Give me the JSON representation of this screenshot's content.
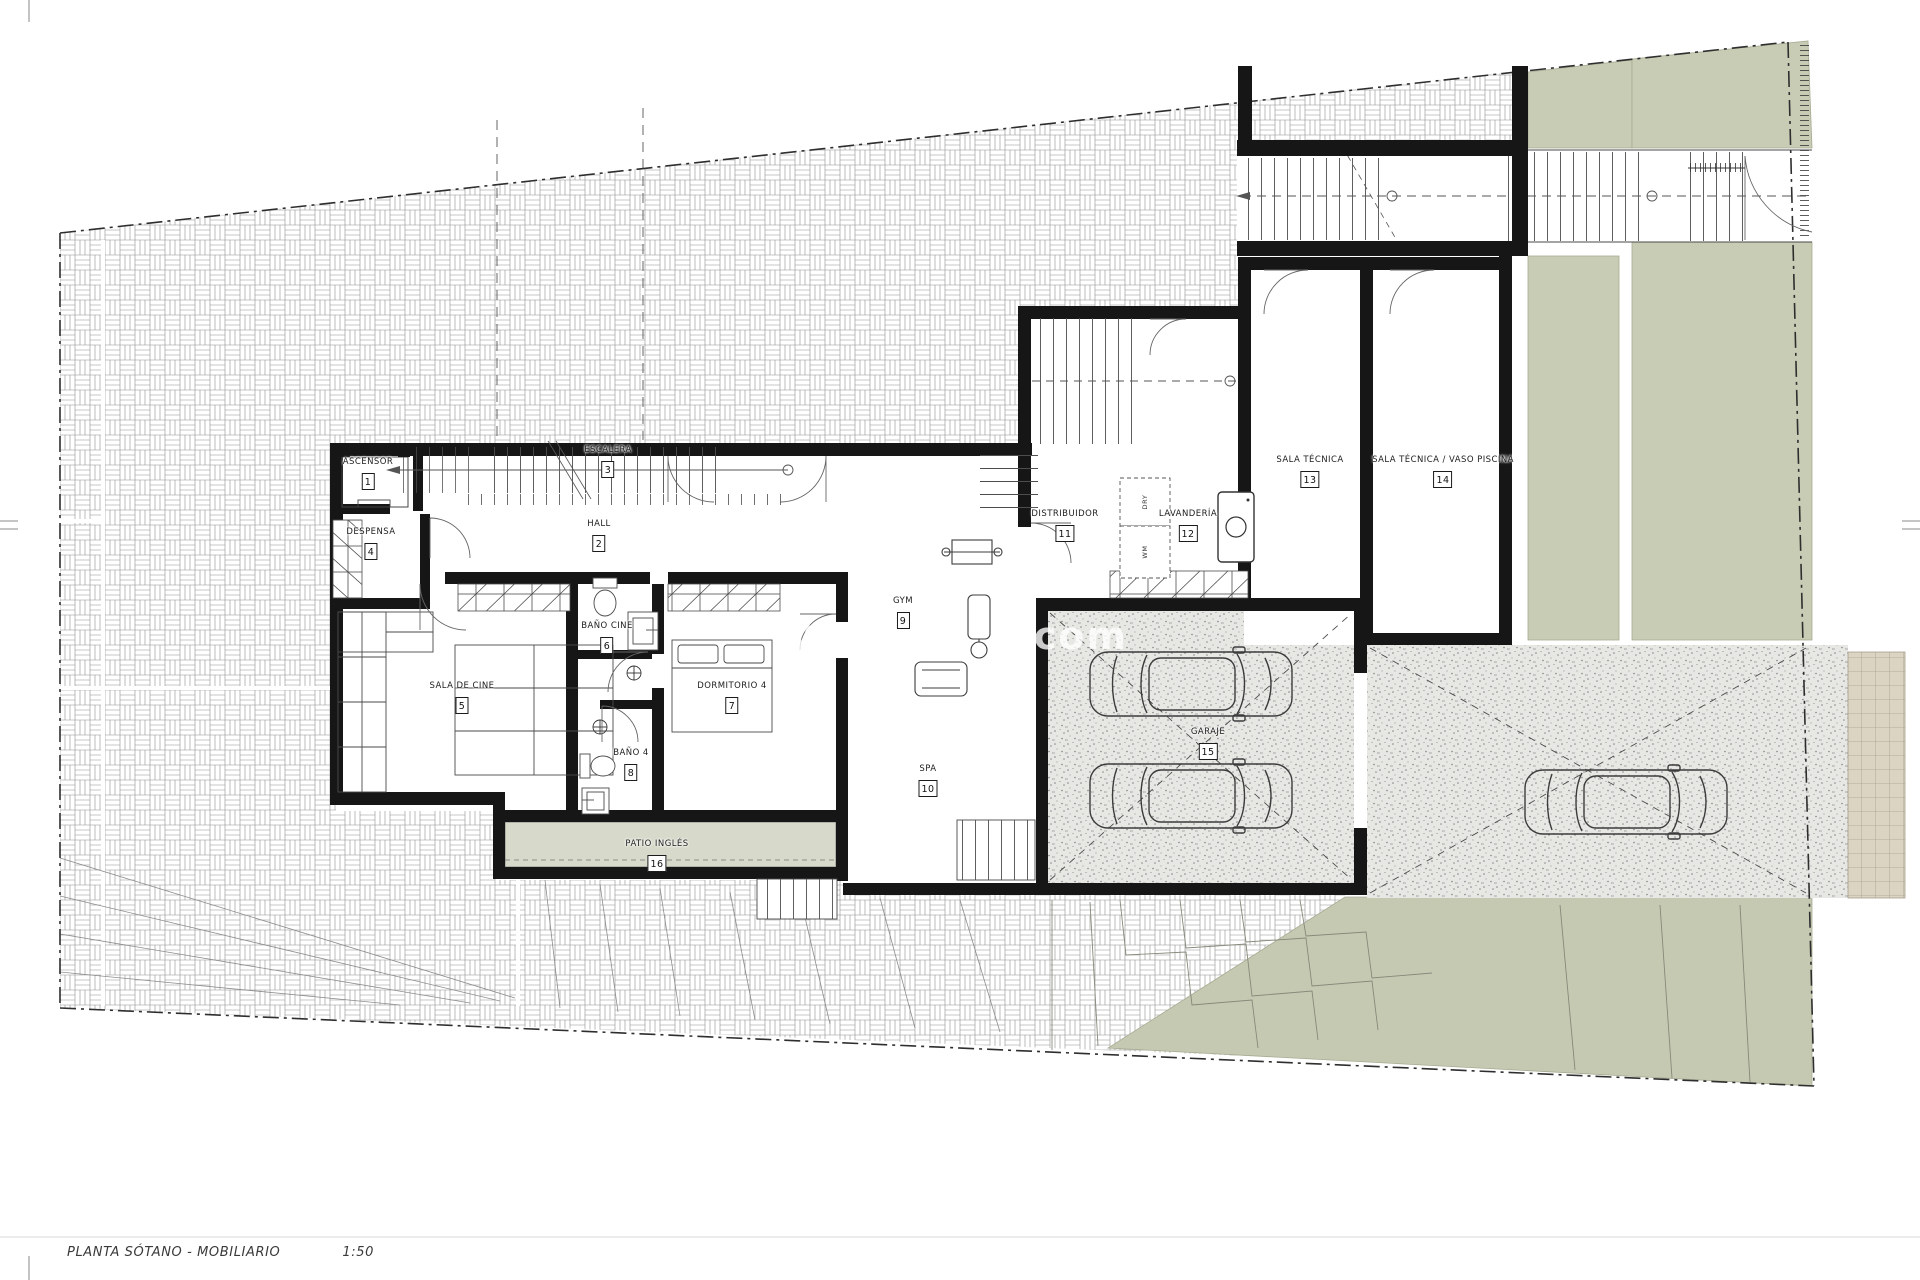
{
  "footer": {
    "title": "PLANTA SÓTANO - MOBILIARIO",
    "scale": "1:50"
  },
  "watermark": {
    "left_fragment": "w",
    "right_fragment": "o.com"
  },
  "rooms": [
    {
      "number": "1",
      "label": "ASCENSOR"
    },
    {
      "number": "2",
      "label": "HALL"
    },
    {
      "number": "3",
      "label": "ESCALERA"
    },
    {
      "number": "4",
      "label": "DESPENSA"
    },
    {
      "number": "5",
      "label": "SALA DE CINE"
    },
    {
      "number": "6",
      "label": "BAÑO CINE"
    },
    {
      "number": "7",
      "label": "DORMITORIO 4"
    },
    {
      "number": "8",
      "label": "BAÑO 4"
    },
    {
      "number": "9",
      "label": "GYM"
    },
    {
      "number": "10",
      "label": "SPA"
    },
    {
      "number": "11",
      "label": "DISTRIBUIDOR"
    },
    {
      "number": "12",
      "label": "LAVANDERÍA"
    },
    {
      "number": "13",
      "label": "SALA TÉCNICA"
    },
    {
      "number": "14",
      "label": "SALA TÉCNICA / VASO PISCINA"
    },
    {
      "number": "15",
      "label": "GARAJE"
    },
    {
      "number": "16",
      "label": "PATIO INGLÉS"
    }
  ],
  "appliances": [
    {
      "label": "DRY"
    },
    {
      "label": "WM"
    }
  ],
  "colors": {
    "wall": "#161616",
    "hatch_line": "#8f8f8f",
    "gravel_bg": "#e7e7e3",
    "green_landscape": "#c9ccb5",
    "green_terrace": "#c6c9b2",
    "patio_fill": "#d7d9ca",
    "retaining_strip": "#dcd4c2",
    "thin_line": "#4a4a4a"
  }
}
